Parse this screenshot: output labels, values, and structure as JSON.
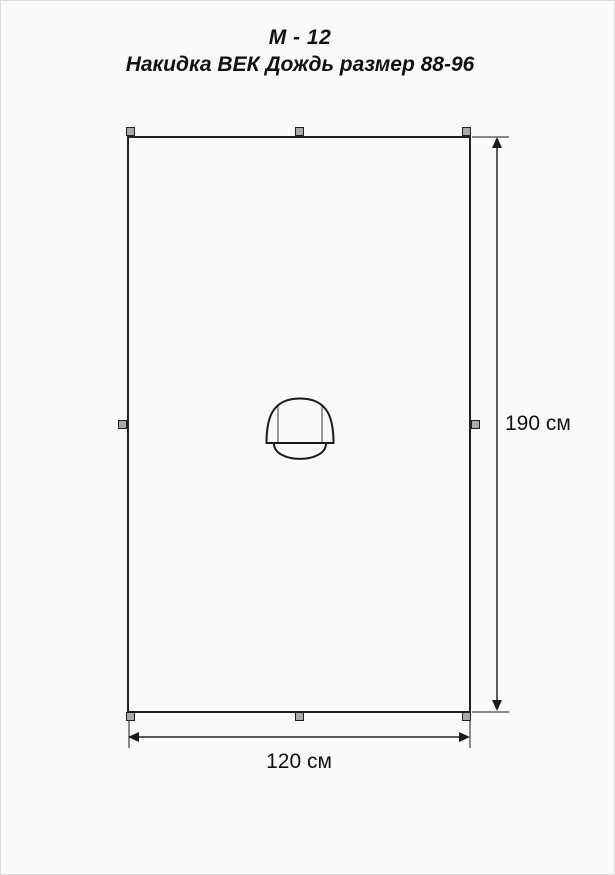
{
  "document": {
    "title_line1": "М - 12",
    "title_line2": "Накидка ВЕК Дождь размер 88-96"
  },
  "dimensions": {
    "height": {
      "value": 190,
      "unit": "см",
      "label": "190 см"
    },
    "width": {
      "value": 120,
      "unit": "см",
      "label": "120 см"
    }
  },
  "drawing": {
    "type": "sewing-pattern",
    "shape": "rectangle-cape-with-center-hood",
    "snaps": [
      "top-left",
      "top-center",
      "top-right",
      "middle-left",
      "middle-right",
      "bottom-left",
      "bottom-center",
      "bottom-right"
    ]
  },
  "colors": {
    "background": "#fafafa",
    "outline": "#222222",
    "dimension_line": "#5a5a5a",
    "extension_line": "#8a8a8a",
    "arrow": "#1a1a1a",
    "snap_fill": "#a9a9a9",
    "fold_line": "#999999",
    "text": "#111111"
  }
}
